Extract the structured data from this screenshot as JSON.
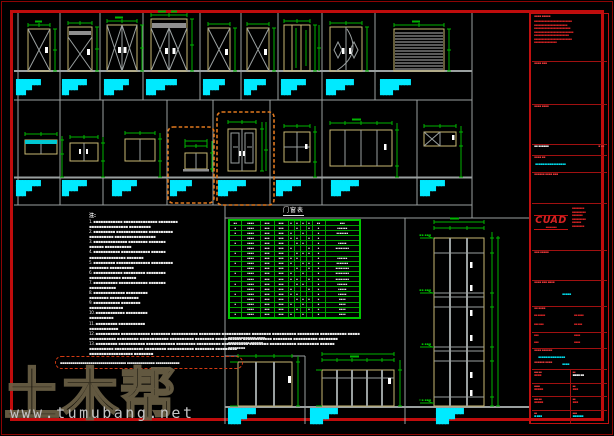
{
  "colors": {
    "background": "#000000",
    "frame_red": "#c00c0c",
    "grid_gray": "#757575",
    "dim_green": "#00b400",
    "label_cyan": "#00eaff",
    "frame_tan": "#c9b872",
    "highlight_orange": "#e0781e"
  },
  "watermark": {
    "logo": "土木帮",
    "url": "www.tumubang.net"
  },
  "notes": {
    "heading": "注:",
    "lines": [
      "1. ▪▪▪▪▪▪▪▪▪▪▪▪ ▪▪▪▪▪▪▪▪▪▪▪▪▪▪ ▪▪▪▪▪▪▪▪",
      "▪▪▪▪▪▪▪▪▪▪▪▪▪▪▪▪ ▪▪▪▪▪▪▪▪▪",
      "2. ▪▪▪▪▪▪▪▪▪ ▪▪▪▪▪▪▪▪▪▪▪▪▪ ▪▪▪▪▪▪▪▪▪▪",
      "▪▪▪▪▪▪▪▪▪▪ ▪▪▪▪▪▪▪▪▪▪▪▪▪▪▪▪▪",
      "3. ▪▪▪▪▪▪▪▪▪▪▪▪▪▪ ▪▪▪▪▪▪▪▪ ▪▪▪▪▪▪▪",
      "▪▪▪▪▪▪ ▪▪▪▪▪▪▪▪▪▪▪",
      "4. ▪▪▪▪▪▪▪▪▪▪▪ ▪▪▪▪▪▪▪▪▪▪▪▪ ▪▪▪▪▪▪",
      "▪▪▪▪▪▪▪▪▪▪▪▪▪▪▪ ▪▪▪▪▪▪▪",
      "5. ▪▪▪▪▪▪▪▪▪ ▪▪▪▪▪▪▪▪▪▪▪▪▪▪ ▪▪▪▪▪▪▪▪▪",
      "▪▪▪▪▪▪▪▪ ▪▪▪▪▪▪▪▪▪▪",
      "6. ▪▪▪▪▪▪▪▪▪▪▪▪ ▪▪▪▪▪▪▪▪▪ ▪▪▪▪▪▪▪▪",
      "▪▪▪▪▪▪▪▪▪▪▪▪▪ ▪▪▪▪▪▪",
      "7. ▪▪▪▪▪▪▪▪▪▪ ▪▪▪▪▪▪▪▪▪▪▪▪ ▪▪▪▪▪▪▪",
      "▪▪▪▪▪▪▪▪▪▪▪",
      "8. ▪▪▪▪▪▪▪▪▪▪▪▪▪ ▪▪▪▪▪▪▪▪▪",
      "▪▪▪▪▪▪▪▪ ▪▪▪▪▪▪▪▪▪▪▪▪",
      "9. ▪▪▪▪▪▪▪▪▪▪▪ ▪▪▪▪▪▪▪▪",
      "▪▪▪▪▪▪▪▪▪▪▪▪▪▪",
      "10. ▪▪▪▪▪▪▪▪▪▪▪▪ ▪▪▪▪▪▪▪▪▪",
      "▪▪▪▪▪▪▪▪▪▪",
      "11. ▪▪▪▪▪▪▪▪▪ ▪▪▪▪▪▪▪▪▪▪▪",
      "▪▪▪▪▪▪▪▪▪▪▪▪",
      "12. ▪▪▪▪▪▪▪▪▪▪ ▪▪▪▪▪▪▪▪▪▪▪▪ ▪▪▪▪▪▪▪▪ ▪▪▪▪▪▪▪▪▪▪▪ ▪▪▪▪▪▪▪▪▪ ▪▪▪▪▪▪▪▪▪▪▪▪ ▪▪▪▪▪▪▪▪ ▪▪▪▪▪▪▪▪▪▪ ▪▪▪▪▪▪▪▪▪ ▪▪▪▪▪▪▪▪▪▪▪ ▪▪▪▪▪",
      "▪▪▪▪▪▪▪▪▪▪▪ ▪▪▪▪▪▪▪▪▪ ▪▪▪▪▪▪▪▪▪▪▪▪ ▪▪▪▪▪▪▪▪▪▪ ▪▪▪▪▪▪▪▪ ▪▪▪▪▪▪▪▪▪▪▪ ▪▪▪▪▪▪▪▪▪▪▪▪ ▪▪▪▪▪▪▪▪ ▪▪▪▪▪▪▪▪▪▪ ▪▪▪▪▪▪▪▪",
      "13. ▪▪▪▪▪▪▪▪▪ ▪▪▪▪▪▪▪▪▪▪▪ ▪▪▪▪▪▪▪▪▪▪▪▪ ▪▪▪▪▪▪▪▪ ▪▪▪▪▪▪▪▪▪▪ ▪▪▪▪▪▪▪▪▪▪▪ ▪▪▪▪▪▪▪▪ ▪▪▪▪▪▪▪▪▪▪▪ ▪▪▪▪▪▪▪▪▪ ▪▪▪▪▪▪",
      "▪▪▪▪▪▪▪▪▪▪ ▪▪▪▪▪▪▪▪▪▪▪▪ ▪▪▪▪▪▪▪▪▪ ▪▪▪▪▪▪▪▪▪▪▪ ▪▪▪▪▪▪▪▪ ▪▪▪▪▪▪▪▪▪",
      "▪▪▪▪▪▪▪▪▪▪▪▪▪▪▪▪▪▪ ▪▪▪▪▪▪▪▪"
    ],
    "highlight": "▪▪▪▪▪▪▪▪▪▪▪▪▪▪▪▪▪▪▪▪▪▪▪▪▪▪▪▪▪▪▪▪▪ ▪▪▪▪▪▪▪▪▪▪▪▪▪▪ ▪▪▪▪▪▪▪▪▪▪▪▪"
  },
  "schedule": {
    "title": "门窗表",
    "rows": [
      [
        "▪▪",
        "▪▪▪▪",
        "▪▪▪",
        "▪▪▪",
        "▪",
        "▪",
        "▪",
        "▪",
        "▪▪",
        "▪▪▪"
      ],
      [
        "▪",
        "▪▪▪▪",
        "▪▪▪",
        "▪▪▪",
        "",
        "▪",
        "",
        "▪",
        "▪",
        "▪▪▪▪▪▪"
      ],
      [
        "▪",
        "▪▪▪▪",
        "▪▪▪",
        "▪▪▪",
        "▪",
        "",
        "▪",
        "",
        "▪",
        "▪▪▪▪▪▪▪"
      ],
      [
        "",
        "▪▪▪▪",
        "▪▪▪",
        "▪▪▪",
        "▪",
        "▪",
        "",
        "▪",
        "▪",
        ""
      ],
      [
        "▪",
        "▪▪▪▪",
        "▪▪▪",
        "▪▪▪",
        "",
        "▪",
        "▪",
        "",
        "▪",
        "▪▪▪▪▪"
      ],
      [
        "",
        "▪▪▪▪",
        "▪▪▪",
        "▪▪▪",
        "▪",
        "",
        "",
        "▪",
        "▪",
        "▪▪▪▪▪▪▪▪"
      ],
      [
        "▪",
        "▪▪▪▪",
        "▪▪▪",
        "▪▪▪",
        "",
        "▪",
        "▪",
        "▪",
        "▪",
        ""
      ],
      [
        "",
        "▪▪▪▪",
        "▪▪▪",
        "▪▪▪",
        "▪",
        "▪",
        "",
        "",
        "▪",
        "▪▪▪▪▪▪"
      ],
      [
        "▪",
        "▪▪▪▪",
        "▪▪▪",
        "▪▪▪",
        "▪",
        "",
        "▪",
        "▪",
        "▪",
        "▪▪▪▪▪▪▪"
      ],
      [
        "",
        "▪▪▪▪",
        "▪▪▪",
        "▪▪▪",
        "",
        "▪",
        "",
        "▪",
        "▪",
        "▪▪▪▪▪▪▪▪"
      ],
      [
        "▪",
        "▪▪▪▪",
        "▪▪▪",
        "▪▪▪",
        "▪",
        "",
        "▪",
        "",
        "▪",
        "▪▪▪▪▪▪▪▪"
      ],
      [
        "",
        "▪▪▪▪",
        "▪▪▪",
        "▪▪▪",
        "▪",
        "▪",
        "",
        "▪",
        "▪",
        "▪▪▪▪▪▪▪▪"
      ],
      [
        "▪",
        "▪▪▪▪",
        "▪▪▪",
        "▪▪▪",
        "",
        "▪",
        "▪",
        "",
        "▪",
        "▪▪▪▪▪▪"
      ],
      [
        "",
        "▪▪▪▪",
        "▪▪▪",
        "▪▪▪",
        "▪",
        "",
        "",
        "▪",
        "▪",
        "▪▪▪▪▪"
      ],
      [
        "▪",
        "▪▪▪▪",
        "▪▪▪",
        "▪▪▪",
        "▪",
        "▪",
        "",
        "",
        "▪",
        "▪▪▪▪▪"
      ],
      [
        "",
        "▪▪▪▪",
        "▪▪▪",
        "▪▪▪",
        "",
        "▪",
        "▪",
        "▪",
        "▪",
        "▪▪▪▪"
      ],
      [
        "▪",
        "▪▪▪▪",
        "▪▪▪",
        "▪▪▪",
        "▪",
        "",
        "▪",
        "",
        "▪",
        "▪▪▪▪"
      ],
      [
        "",
        "▪▪▪▪",
        "▪▪▪",
        "▪▪▪",
        "",
        "▪",
        "",
        "▪",
        "▪",
        "▪▪▪▪"
      ],
      [
        "▪",
        "▪▪▪▪",
        "▪▪▪",
        "▪▪▪",
        "▪",
        "",
        "▪",
        "",
        "▪",
        "▪▪▪▪"
      ]
    ],
    "footnotes": [
      "▪▪▪▪▪▪▪▪▪▪▪▪▪ ▪▪▪▪",
      "▪▪▪▪▪▪▪▪▪▪ ▪▪▪▪▪▪",
      "▪▪▪▪▪▪▪▪"
    ]
  },
  "labels": {
    "row1": [
      {
        "x": 16,
        "l1": "████████",
        "l2": "█████",
        "l3": "███"
      },
      {
        "x": 62,
        "l1": "████████",
        "l2": "█████",
        "l3": "██"
      },
      {
        "x": 104,
        "l1": "████████",
        "l2": "██████",
        "l3": "███"
      },
      {
        "x": 146,
        "l1": "██████████",
        "l2": "██████",
        "l3": "███"
      },
      {
        "x": 203,
        "l1": "███████",
        "l2": "█████",
        "l3": "██"
      },
      {
        "x": 244,
        "l1": "███████",
        "l2": "████",
        "l3": "██"
      },
      {
        "x": 281,
        "l1": "████████",
        "l2": "█████",
        "l3": "███"
      },
      {
        "x": 326,
        "l1": "█████████",
        "l2": "██████",
        "l3": "███"
      },
      {
        "x": 380,
        "l1": "██████████",
        "l2": "██████",
        "l3": "████"
      }
    ],
    "row2": [
      {
        "x": 16,
        "l1": "████████",
        "l2": "█████",
        "l3": "███"
      },
      {
        "x": 62,
        "l1": "████████",
        "l2": "█████",
        "l3": "██"
      },
      {
        "x": 112,
        "l1": "████████",
        "l2": "██████",
        "l3": "███"
      },
      {
        "x": 170,
        "l1": "███████",
        "l2": "█████",
        "l3": "██"
      },
      {
        "x": 218,
        "l1": "█████████",
        "l2": "██████",
        "l3": "███"
      },
      {
        "x": 276,
        "l1": "████████",
        "l2": "█████",
        "l3": "██"
      },
      {
        "x": 331,
        "l1": "█████████",
        "l2": "██████",
        "l3": "███"
      },
      {
        "x": 420,
        "l1": "████████",
        "l2": "█████",
        "l3": "███"
      }
    ],
    "bottom": [
      {
        "x": 228,
        "l1": "█████████",
        "l2": "██████",
        "l3": "████"
      },
      {
        "x": 310,
        "l1": "█████████",
        "l2": "██████",
        "l3": "████"
      },
      {
        "x": 436,
        "l1": "█████████",
        "l2": "██████",
        "l3": "████"
      }
    ]
  },
  "levels": [
    "▪▪.▪▪▪",
    "▪▪.▪▪▪",
    "▪.▪▪▪",
    "±▪.▪▪▪"
  ],
  "titleblock": {
    "s1c": "▪▪▪▪ ▪▪▪▪▪",
    "s1l": [
      "▪▪▪▪▪▪▪▪▪▪▪▪▪▪▪▪▪▪▪▪▪▪▪▪▪",
      "▪▪▪▪▪▪▪▪▪▪▪▪▪▪▪▪▪▪▪▪▪▪",
      "▪▪▪▪▪▪▪▪▪▪▪▪▪▪▪▪▪▪▪▪▪▪▪▪",
      "▪▪▪▪▪▪▪▪▪▪▪▪▪▪▪▪▪▪▪▪▪▪▪▪▪▪",
      "▪▪▪▪▪▪▪▪▪▪▪▪▪▪▪▪▪▪▪▪▪▪▪",
      "▪▪▪▪▪▪▪▪▪▪▪▪▪▪▪▪▪▪▪▪▪▪▪▪▪",
      "▪▪▪▪▪▪▪▪▪▪▪▪▪▪▪"
    ],
    "s2c": "▪▪▪▪ ▪▪▪",
    "s3c": "▪▪▪▪ ▪▪▪▪",
    "s4l": "▪▪ ▪▪▪▪▪▪",
    "s4r": "▪ ▪▪",
    "s5c": "▪▪▪▪ ▪▪",
    "s5v": "▪▪▪▪▪▪▪▪▪▪▪▪▪▪▪▪▪",
    "s6c": "▪▪▪▪▪▪ ▪▪▪▪ ▪▪▪",
    "logo": "CUAD",
    "logo_sub": "▪▪▪▪▪▪▪▪",
    "logo_l": [
      "▪▪▪▪▪▪▪▪",
      "▪▪▪▪▪▪▪▪▪",
      "▪▪▪▪▪▪▪",
      "▪▪▪▪▪▪▪▪▪",
      "▪▪▪▪▪▪",
      "▪▪▪▪▪▪▪▪"
    ],
    "s8c": "▪▪▪ ▪▪▪▪▪",
    "s9c": "▪▪▪▪ ▪▪▪ ▪▪▪▪",
    "s9v": "▪▪▪▪▪",
    "s10c": "▪▪ ▪▪▪▪",
    "s10a": "▪▪ ▪▪▪▪▪",
    "s10b": "▪▪ ▪▪▪▪",
    "s10d": "▪▪▪ ▪▪▪",
    "s10e": "▪▪ ▪▪▪",
    "s11a": "▪▪▪",
    "s11b": "▪▪▪▪",
    "s11c": "▪▪▪",
    "s11d": "▪▪▪▪",
    "s12c": "▪▪▪▪ ▪▪▪▪▪▪",
    "s12v1": "▪▪▪▪▪▪▪▪▪▪▪▪▪▪▪",
    "s12c2": "▪▪▪▪▪▪ ▪▪▪▪",
    "s12v2": "▪▪▪▪",
    "g": [
      {
        "l": "▪▪▪ ▪▪",
        "v": "▪▪▪▪"
      },
      {
        "l": "▪▪",
        "v": "▪▪▪▪ ▪▪"
      },
      {
        "l": "▪▪▪▪",
        "v": "▪▪▪▪▪"
      },
      {
        "l": "▪▪",
        "v": "▪▪▪"
      },
      {
        "l": "▪▪▪ ▪▪",
        "v": "▪▪▪▪▪"
      },
      {
        "l": "▪▪",
        "v": "▪▪▪"
      },
      {
        "l": "▪▪",
        "v": "▪ ▪▪▪"
      },
      {
        "l": "▪▪▪",
        "v": "▪▪▪▪▪▪"
      }
    ]
  }
}
